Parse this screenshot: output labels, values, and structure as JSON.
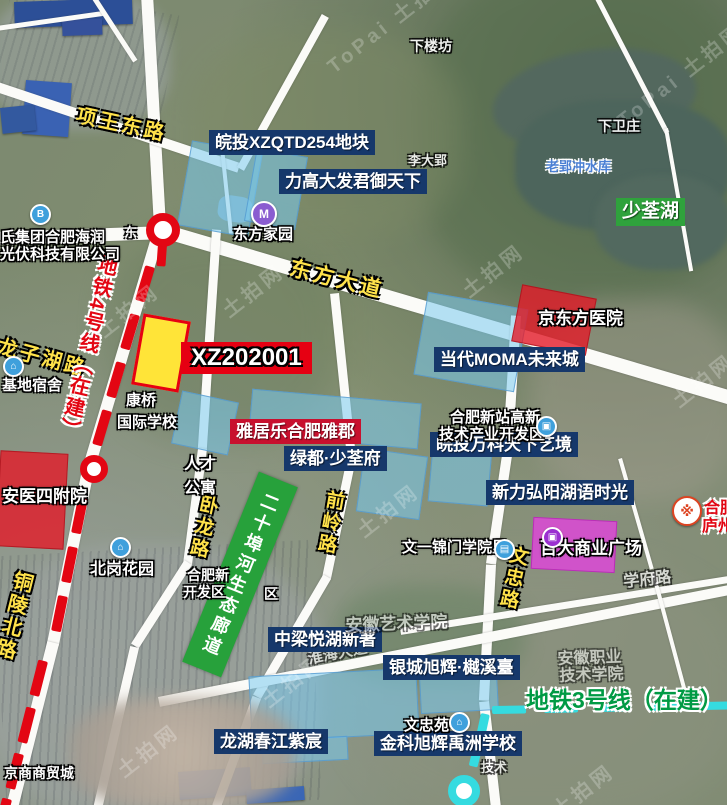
{
  "watermark": {
    "brand": "ToPai",
    "text": "土拍网"
  },
  "metro": {
    "line4_label": "地铁4号线（在建）",
    "line3_label": "地铁3号线（在建）",
    "station_partial": "东"
  },
  "roads": {
    "xiangwang": "项王东路",
    "dongfang": "东方大道",
    "longzihu": "龙子湖路",
    "tongling": "铜陵北路",
    "wolong": "卧龙路",
    "qianling": "前岭路",
    "wenzhong": "文忠路",
    "xuefu": "学府路",
    "huaihai": "淮海大道"
  },
  "parcels": {
    "xz": "XZ202001"
  },
  "projects": {
    "wantou254": "皖投XZQTD254地块",
    "ligao": "力高大发君御天下",
    "moma": "当代MOMA未来城",
    "wanke": "皖投万科天下艺境",
    "xinli": "新力弘阳湖语时光",
    "yajule": "雅居乐合肥雅郡",
    "lvdu": "绿都·少荃府",
    "zhongliang": "中梁悦湖新著",
    "yincheng": "银城旭辉·樾溪臺",
    "longhu": "龙湖春江紫宸",
    "jinke": "金科旭辉禹洲学校",
    "baida": "百大商业广场"
  },
  "places": {
    "shaoquanhu": "少荃湖",
    "corridor": "二十埠河生态廊道",
    "bojing": "京东方医院",
    "anyi": "安医四附院",
    "rencai_l1": "人才",
    "rencai_l2": "公寓",
    "kangqiao_l1": "康桥",
    "kangqiao_l2": "国际学校",
    "gaoxin_l1": "合肥新站高新",
    "gaoxin_l2": "技术产业开发区",
    "kaifa_l1": "合肥新",
    "kaifa_l2": "开发区",
    "kaifa_r": "区",
    "wenyi": "文一锦门学院里",
    "beigang": "北岗花园",
    "sushe": "基地宿舍",
    "haijun_l1": "氏集团合肥海润",
    "haijun_l2": "光伏科技有限公司",
    "dfjy": "东方家园",
    "xialoufang": "下楼坊",
    "xiaweizhuang": "下卫庄",
    "laoying": "老郢冲水库",
    "lidaying": "李大郢",
    "wenzhongyuan": "文忠苑",
    "yishu": "安徽艺术学院",
    "zhiye_l1": "安徽职业",
    "zhiye_l2": "技术学院",
    "jishu": "技术",
    "jingshang": "京商商贸城",
    "seal_l1": "合肥",
    "seal_l2": "庐州"
  },
  "icons": {
    "company": "B",
    "dorm": "⌂",
    "park": "⌂",
    "gov": "▣",
    "school": "▤",
    "estate": "⌂",
    "metro": "M",
    "plaza": "▣",
    "seal": "※"
  }
}
